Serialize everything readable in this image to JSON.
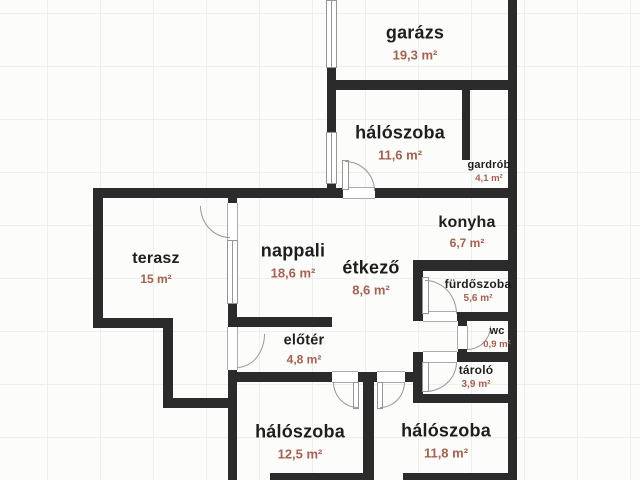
{
  "plan_title": "floor-plan",
  "unit": "m²",
  "colors": {
    "wall": "#2b2b2b",
    "room_label": "#1e1e1e",
    "area_label": "#a8604e",
    "background": "#fcfcfb",
    "grid_line": "#f0edeb",
    "frame_line": "#979797"
  },
  "rooms": [
    {
      "name": "garázs",
      "area": "19,3 m²"
    },
    {
      "name": "hálószoba",
      "area": "11,6 m²"
    },
    {
      "name": "gardrób",
      "area": "4,1 m²"
    },
    {
      "name": "konyha",
      "area": "6,7 m²"
    },
    {
      "name": "terasz",
      "area": "15 m²"
    },
    {
      "name": "nappali",
      "area": "18,6 m²"
    },
    {
      "name": "étkező",
      "area": "8,6 m²"
    },
    {
      "name": "előtér",
      "area": "4,8 m²"
    },
    {
      "name": "fürdőszoba",
      "area": "5,6 m²"
    },
    {
      "name": "wc",
      "area": "0,9 m²"
    },
    {
      "name": "tároló",
      "area": "3,9 m²"
    },
    {
      "name": "hálószoba",
      "area": "12,5 m²"
    },
    {
      "name": "hálószoba",
      "area": "11,8 m²"
    }
  ]
}
